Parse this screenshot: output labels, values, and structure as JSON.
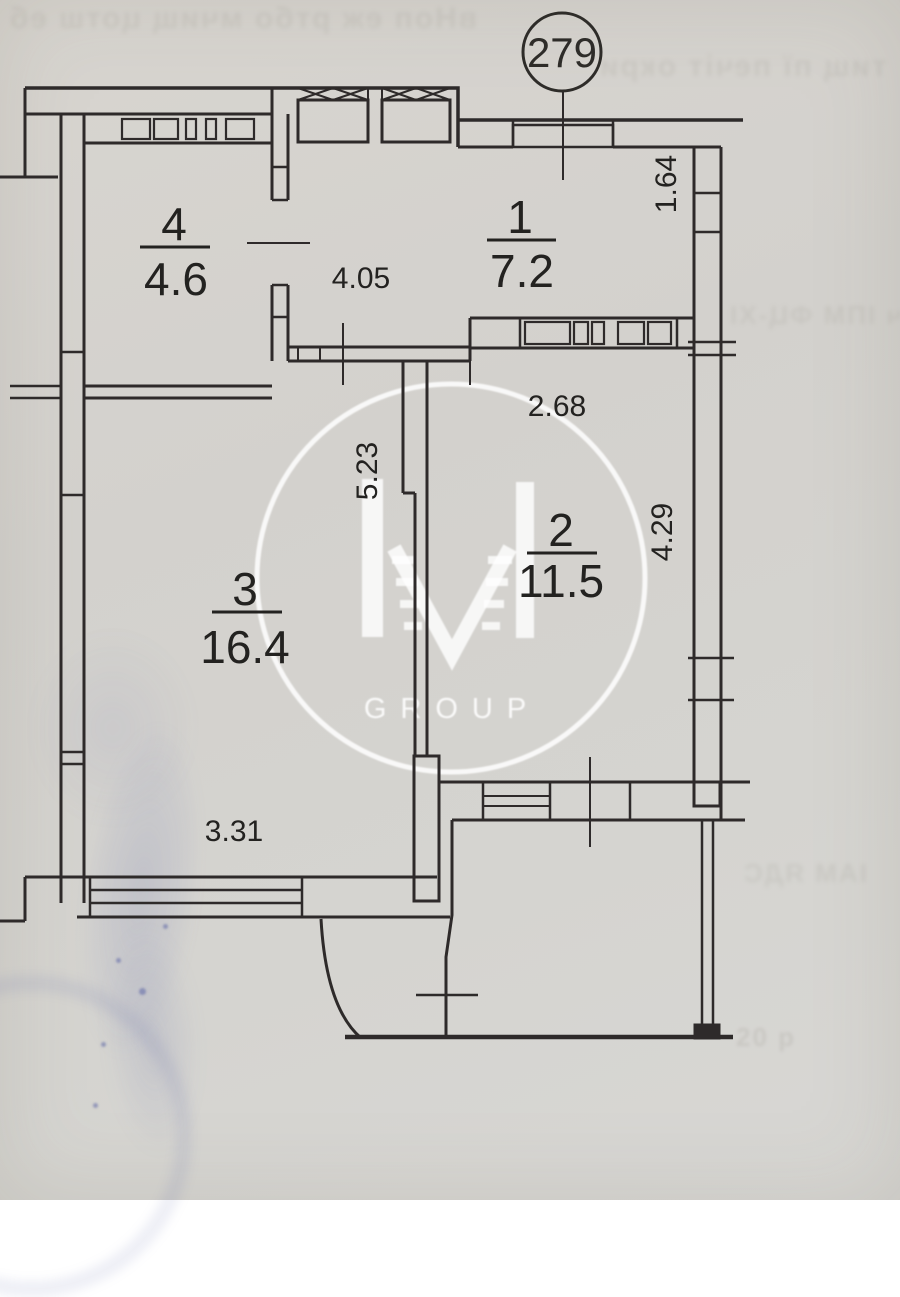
{
  "document": {
    "type": "scanned apartment floor plan"
  },
  "apartment": {
    "number": "279"
  },
  "rooms": {
    "r1": {
      "number": "1",
      "area": "7.2"
    },
    "r2": {
      "number": "2",
      "area": "11.5"
    },
    "r3": {
      "number": "3",
      "area": "16.4"
    },
    "r4": {
      "number": "4",
      "area": "4.6"
    }
  },
  "dimensions": {
    "top_right_vertical": "1.64",
    "hall_width": "4.05",
    "room2_width": "2.68",
    "partition_length": "5.23",
    "room2_height": "4.29",
    "room3_bottom_width": "3.31"
  },
  "watermark": {
    "brand": "IVI",
    "subtext": "GROUP"
  },
  "colors": {
    "ink": "#2e2c29",
    "paper": "#d4d2ce",
    "stamp_blue": "#5a64a8",
    "watermark": "#ffffff"
  },
  "artifacts": {
    "bleed_top_left": "вНоп еж ртбо мчищ цотш еб",
    "bleed_top_right": "тищ пї печіт окри",
    "bleed_mid_right": "ГВ-ыч ІПМ ФЦ-ХІ",
    "bleed_low_right": "ІАМ ЯДС",
    "bleed_bottom_right": "20 р"
  }
}
